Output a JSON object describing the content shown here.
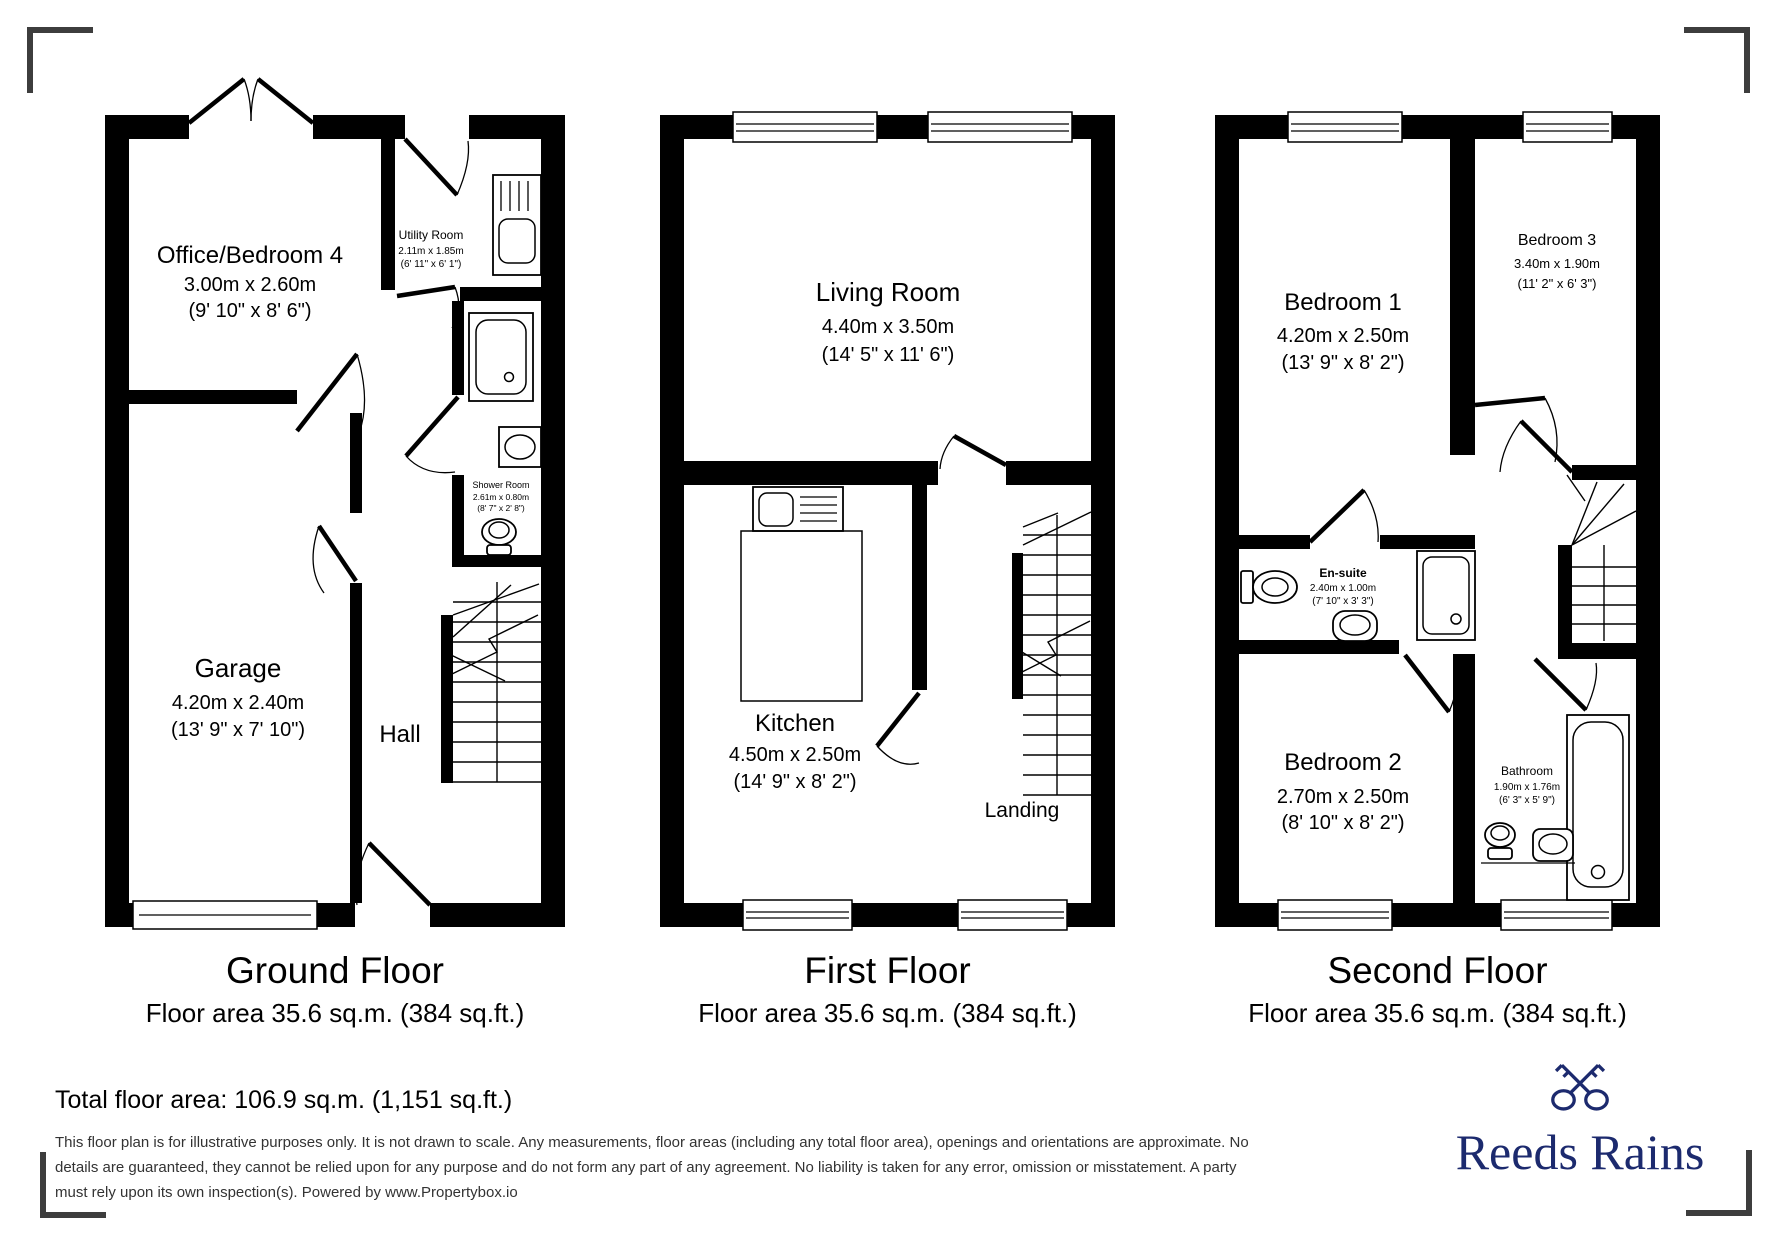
{
  "brand": {
    "name": "Reeds Rains",
    "logo_color": "#1c2a6e",
    "icon": "crossed-keys-icon"
  },
  "summary": {
    "total_floor_area": "Total floor area: 106.9 sq.m. (1,151 sq.ft.)",
    "disclaimer_lines": [
      "This floor plan is for illustrative purposes only. It is not drawn to scale. Any measurements, floor areas (including any total floor area), openings and orientations are approximate. No",
      "details are guaranteed, they cannot be relied upon for any purpose and do not form any part of any agreement. No liability is taken for any error, omission or misstatement. A party",
      "must rely upon its own inspection(s). Powered by www.Propertybox.io"
    ]
  },
  "floors": [
    {
      "title": "Ground Floor",
      "area": "Floor area 35.6 sq.m. (384 sq.ft.)",
      "rooms": [
        {
          "name": "Office/Bedroom 4",
          "dim_m": "3.00m x 2.60m",
          "dim_ft": "(9' 10\" x 8' 6\")"
        },
        {
          "name": "Utility Room",
          "dim_m": "2.11m x 1.85m",
          "dim_ft": "(6' 11\" x 6' 1\")"
        },
        {
          "name": "Shower Room",
          "dim_m": "2.61m x 0.80m",
          "dim_ft": "(8' 7\" x 2' 8\")"
        },
        {
          "name": "Garage",
          "dim_m": "4.20m x 2.40m",
          "dim_ft": "(13' 9\" x 7' 10\")"
        },
        {
          "name": "Hall",
          "dim_m": "",
          "dim_ft": ""
        }
      ]
    },
    {
      "title": "First Floor",
      "area": "Floor area 35.6 sq.m. (384 sq.ft.)",
      "rooms": [
        {
          "name": "Living Room",
          "dim_m": "4.40m x 3.50m",
          "dim_ft": "(14' 5\" x 11' 6\")"
        },
        {
          "name": "Kitchen",
          "dim_m": "4.50m x 2.50m",
          "dim_ft": "(14' 9\" x 8' 2\")"
        },
        {
          "name": "Landing",
          "dim_m": "",
          "dim_ft": ""
        }
      ]
    },
    {
      "title": "Second Floor",
      "area": "Floor area 35.6 sq.m. (384 sq.ft.)",
      "rooms": [
        {
          "name": "Bedroom 1",
          "dim_m": "4.20m x 2.50m",
          "dim_ft": "(13' 9\" x 8' 2\")"
        },
        {
          "name": "Bedroom 3",
          "dim_m": "3.40m x 1.90m",
          "dim_ft": "(11' 2\" x 6' 3\")"
        },
        {
          "name": "En-suite",
          "dim_m": "2.40m x 1.00m",
          "dim_ft": "(7' 10\" x 3' 3\")"
        },
        {
          "name": "Bedroom 2",
          "dim_m": "2.70m x 2.50m",
          "dim_ft": "(8' 10\" x 8' 2\")"
        },
        {
          "name": "Bathroom",
          "dim_m": "1.90m x 1.76m",
          "dim_ft": "(6' 3\" x 5' 9\")"
        }
      ]
    }
  ],
  "colors": {
    "wall": "#000000",
    "bracket": "#3d3d3d",
    "disclaimer_text": "#333333",
    "navy": "#1c2a6e"
  }
}
